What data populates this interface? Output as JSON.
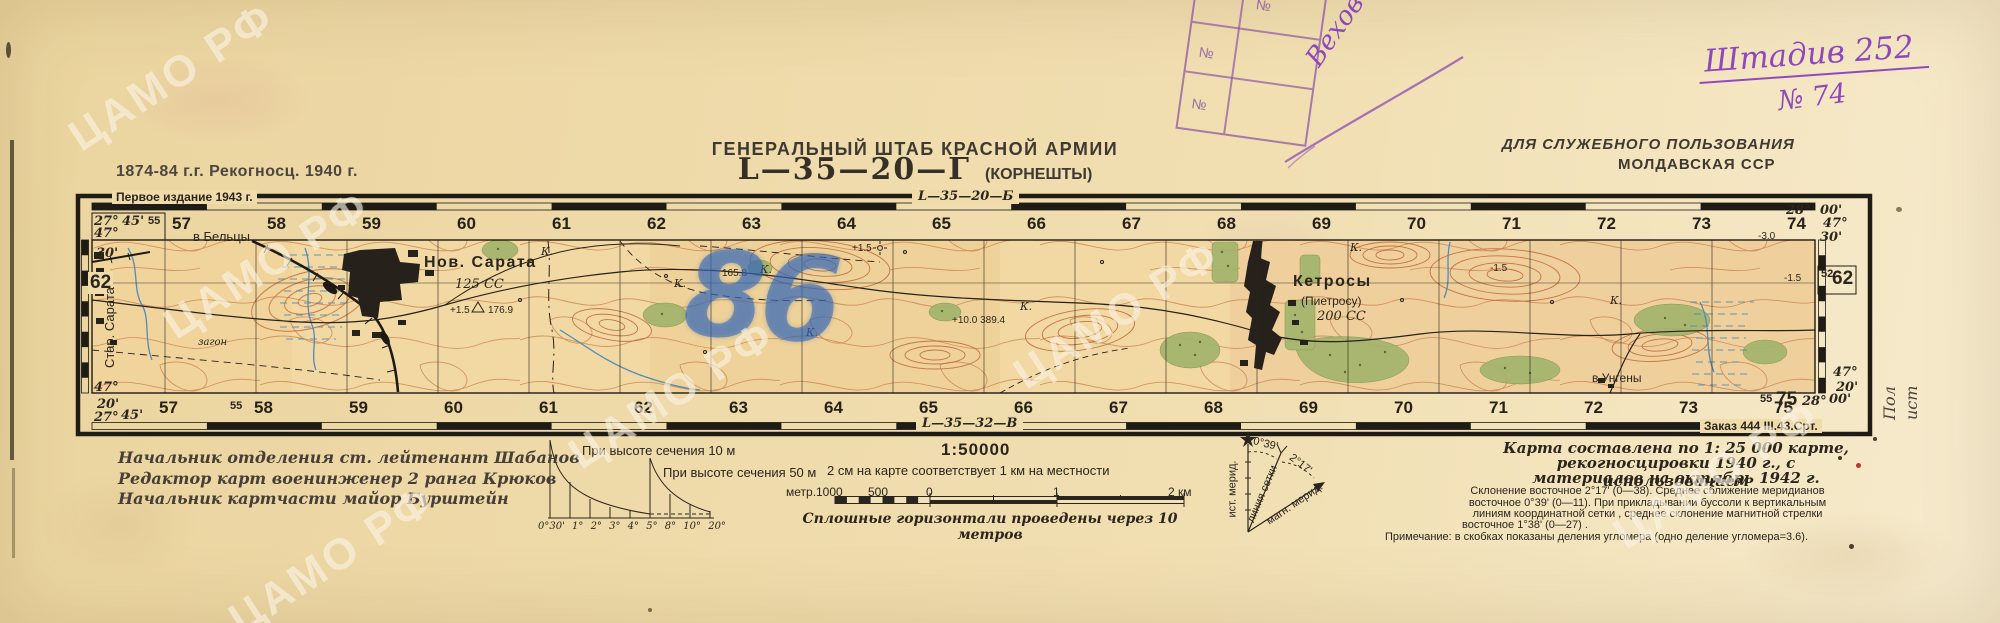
{
  "header": {
    "survey_dates": "1874-84 г.г.   Рекогносц. 1940 г.",
    "organization": "ГЕНЕРАЛЬНЫЙ ШТАБ КРАСНОЙ АРМИИ",
    "sheet_code": "L—35—20—Г",
    "sheet_name": "(КОРНЕШТЫ)",
    "classification": "ДЛЯ СЛУЖЕБНОГО ПОЛЬЗОВАНИЯ",
    "region": "МОЛДАВСКАЯ ССР"
  },
  "handwriting": {
    "unit_note": "Штадив 252",
    "copy_number": "№ 74",
    "stamp_signature": "Вехов 74",
    "blue_mark": "86",
    "margin_note_line1": "Пол",
    "margin_note_line2": "ист"
  },
  "stamp": {
    "no_sign": "№",
    "number": "1536"
  },
  "frame": {
    "first_edition": "Первое издание 1943 г.",
    "adjacent_top": "L—35—20—Б",
    "adjacent_bottom": "L—35—32—В",
    "print_order": "Заказ 444  III.43.Срт.",
    "grid_top": [
      "57",
      "58",
      "59",
      "60",
      "61",
      "62",
      "63",
      "64",
      "65",
      "66",
      "67",
      "68",
      "69",
      "70",
      "71",
      "72",
      "73",
      "74"
    ],
    "grid_bottom": [
      "57",
      "58",
      "59",
      "60",
      "61",
      "62",
      "63",
      "64",
      "65",
      "66",
      "67",
      "68",
      "69",
      "70",
      "71",
      "72",
      "73",
      "75"
    ],
    "corner_tl": {
      "lon_deg": "27°",
      "lat_deg": "47°",
      "lon_min": "45'",
      "small": "55"
    },
    "edge_left": {
      "lat_min": "30'",
      "grid": "62"
    },
    "corner_bl": {
      "lat_deg": "47°",
      "lat_min": "20'",
      "lon_deg": "27°",
      "lon_min": "45'"
    },
    "corner_tr": {
      "lon_deg": "28°",
      "lon_min": "00'",
      "lat_deg": "47°",
      "lat_min": "30'"
    },
    "edge_right": {
      "grid_small": "52",
      "grid": "62"
    },
    "corner_br": {
      "lat_deg": "47°",
      "lat_min": "20'",
      "small": "55",
      "grid": "75",
      "lon_deg": "28°",
      "lon_min": "00'"
    },
    "bottom_small_55": "55"
  },
  "map": {
    "exit_top": "в Бельцы",
    "exit_bottom": "в Унгены",
    "village_left": "Стар. Сарата",
    "nov_sarata": "Нов. Сарата",
    "nov_sarata_info": "125 СС",
    "ns_h_left": "+1.5",
    "ns_h_right": "176.9",
    "ketrosy": "Кетросы",
    "ketrosy_alt": "(Пиетросу)",
    "ketrosy_info": "200 СС",
    "kurgan": "К.",
    "height_165": "165.8",
    "plus15": "+1.5",
    "height_389": "+10.0  389.4",
    "minus30": "-3.0",
    "minus15": "-1.5",
    "zagon": "загон"
  },
  "legend": {
    "signature1": "Начальник отделения   ст. лейтенант Шабанов",
    "signature2": "Редактор карт военинженер 2 ранга Крюков",
    "signature3": "Начальник картчасти майор Бурштейн",
    "slope_caption_10": "При высоте сечения 10 м",
    "slope_caption_50": "При высоте сечения 50 м",
    "slope_degrees": [
      "0°30'",
      "1°",
      "2°",
      "3°",
      "4°",
      "5°",
      "8°",
      "10°",
      "20°"
    ],
    "scale": "1:50000",
    "scale_note": "2 см на карте соответствует 1 км на местности",
    "bar_unit": "метр.",
    "bar_1000": "1000",
    "bar_500": "500",
    "bar_0": "0",
    "bar_km1": "1",
    "bar_km2": "2 км",
    "contour_note": "Сплошные горизонтали проведены через 10 метров",
    "decl_small_angle": "0°39'",
    "decl_big_angle": "2°17'",
    "true_meridian": "ист. мерид.",
    "grid_line_label": "линия сетки",
    "magnetic_meridian": "магн. мерид.",
    "compiled1": "Карта составлена по 1: 25 000 карте,",
    "compiled2": "рекогносцировки 1940 г., с использованием",
    "compiled3": "материалов на октябрь 1942 г.",
    "declination1": "Склонение восточное 2°17' (0—38).  Среднее сближение меридианов",
    "declination2": "восточное 0°39' (0—11). При прикладывании буссоли к вертикальным",
    "declination3": "линиям координатной сетки , среднее склонение магнитной стрелки",
    "declination4": "восточное  1°38' (0—27) .",
    "note": "Примечание: в скобках показаны деления угломера (одно деление угломера=3.6)."
  },
  "watermark": "ЦАМО РФ",
  "colors": {
    "paper": "#f0dcab",
    "ink": "#2a251d",
    "contour": "#c06a38",
    "water": "#4f8cba",
    "forest": "#a3b46c",
    "purple": "#8b4ab8",
    "blue_pencil": "#3a6cc0"
  }
}
